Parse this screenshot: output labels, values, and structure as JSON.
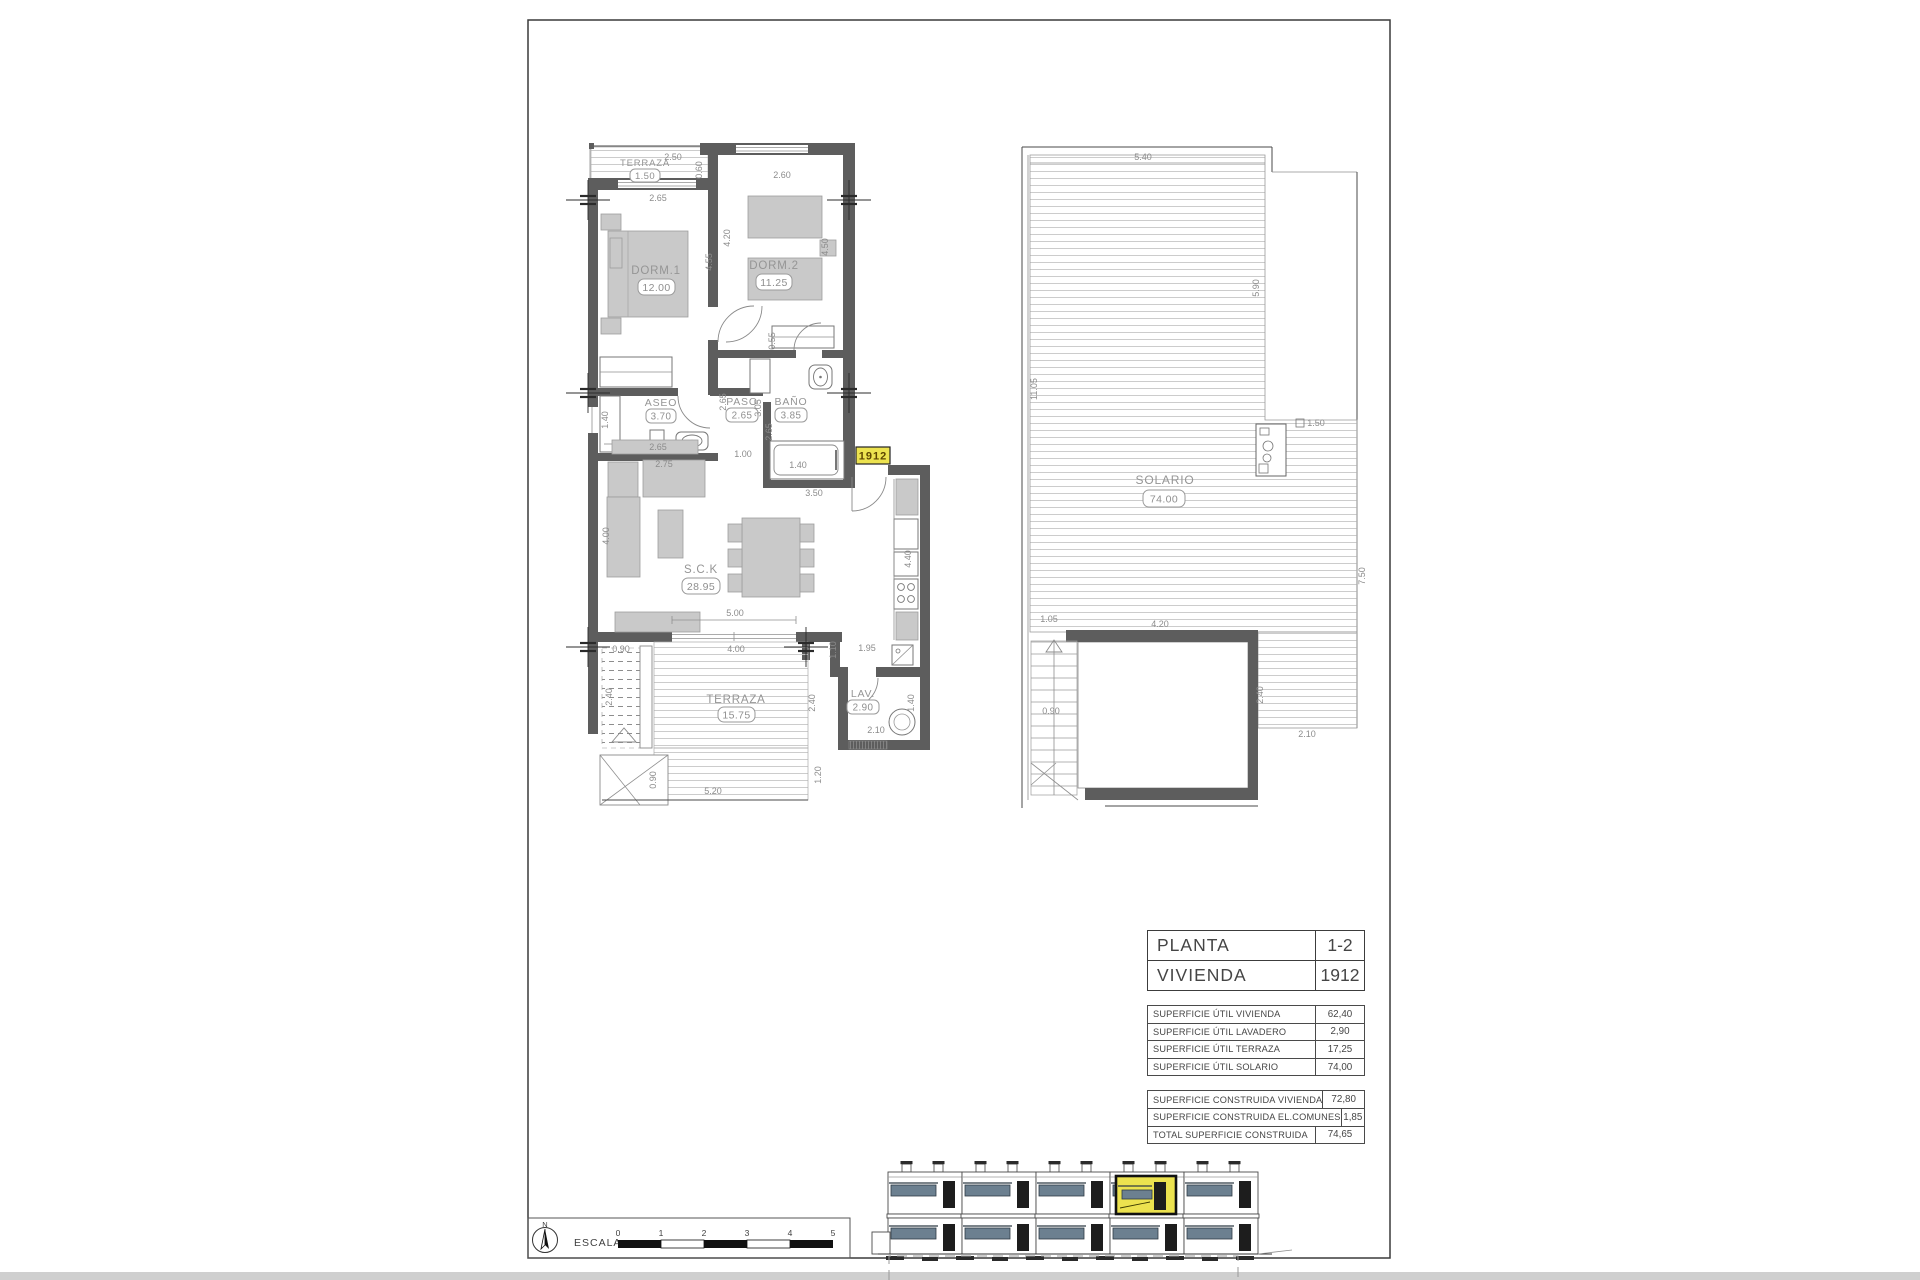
{
  "sheet": {
    "unit_badge": "1912"
  },
  "floor_plan": {
    "rooms": {
      "terraza_top": {
        "name": "TERRAZA",
        "area": "1.50"
      },
      "dorm1": {
        "name": "DORM.1",
        "area": "12.00"
      },
      "dorm2": {
        "name": "DORM.2",
        "area": "11.25"
      },
      "aseo": {
        "name": "ASEO",
        "area": "3.70"
      },
      "paso": {
        "name": "PASO",
        "area": "2.65"
      },
      "bano": {
        "name": "BAÑO",
        "area": "3.85"
      },
      "sck": {
        "name": "S.C.K",
        "area": "28.95"
      },
      "terraza": {
        "name": "TERRAZA",
        "area": "15.75"
      },
      "lav": {
        "name": "LAV.",
        "area": "2.90"
      }
    },
    "dims": [
      "2.50",
      "0.60",
      "2.65",
      "2.60",
      "4.55",
      "4.20",
      "4.50",
      "0.55",
      "1.40",
      "2.65",
      "2.65",
      "3.05",
      "2.65",
      "1.00",
      "1.40",
      "3.50",
      "2.75",
      "4.00",
      "5.00",
      "4.00",
      "0.90",
      "2.40",
      "2.40",
      "0.90",
      "5.20",
      "1.20",
      "1.10",
      "1.95",
      "4.40",
      "2.10",
      "1.40"
    ]
  },
  "solario": {
    "name": "SOLARIO",
    "area": "74.00",
    "dims": [
      "5.40",
      "5.90",
      "11.05",
      "1.50",
      "7.50",
      "1.05",
      "4.20",
      "0.90",
      "2.40",
      "2.10"
    ]
  },
  "info_table": {
    "header": [
      {
        "label": "PLANTA",
        "value": "1-2"
      },
      {
        "label": "VIVIENDA",
        "value": "1912"
      }
    ],
    "util": [
      {
        "label": "SUPERFICIE ÚTIL VIVIENDA",
        "value": "62,40"
      },
      {
        "label": "SUPERFICIE ÚTIL LAVADERO",
        "value": "2,90"
      },
      {
        "label": "SUPERFICIE ÚTIL TERRAZA",
        "value": "17,25"
      },
      {
        "label": "SUPERFICIE ÚTIL SOLARIO",
        "value": "74,00"
      }
    ],
    "construida": [
      {
        "label": "SUPERFICIE CONSTRUIDA VIVIENDA",
        "value": "72,80"
      },
      {
        "label": "SUPERFICIE CONSTRUIDA EL.COMUNES",
        "value": "1,85"
      },
      {
        "label": "TOTAL SUPERFICIE CONSTRUIDA",
        "value": "74,65"
      }
    ]
  },
  "scale_bar": {
    "label": "ESCALA :",
    "north": "N",
    "ticks": [
      "0",
      "1",
      "2",
      "3",
      "4",
      "5"
    ]
  },
  "colors": {
    "highlight": "#ece24f",
    "railing": "#6c8090",
    "wall": "#5d5d5d"
  }
}
